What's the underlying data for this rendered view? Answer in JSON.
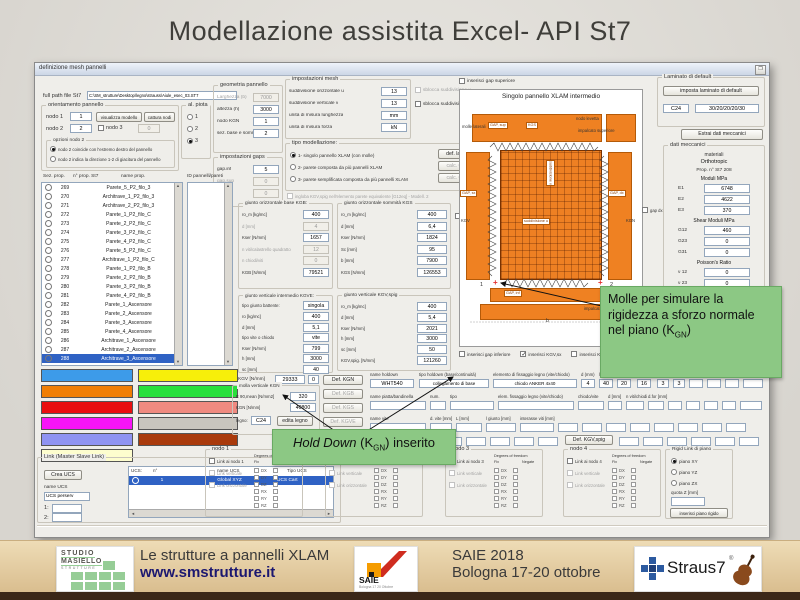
{
  "slide": {
    "title": "Modellazione assistita Excel- API St7"
  },
  "win": {
    "title": "definizione mesh pannelli"
  },
  "fullpath": {
    "label": "full path file St7",
    "value": "C:\\SM_strutture\\Desktop\\legno\\strauss\\Aiule_esec_03.ST7"
  },
  "orient": {
    "title": "orientamento pannello",
    "nodo1": "nodo 1",
    "nodo1_v": "1",
    "btn_vis": "visualizza modello",
    "btn_cat": "cattura nodi",
    "nodo2": "nodo 2",
    "nodo2_v": "2",
    "nodo3": "nodo 3",
    "nodo3_v": "0",
    "opz_title": "opzioni nodo 2",
    "r1": "nodo 2 coincide con l'estremo destro del pannello",
    "r2": "nodo 2 indica la direzione 1-2 di giacitura del pannello"
  },
  "alpiota": {
    "title": "al. piota",
    "opts": [
      "1",
      "2",
      "3"
    ]
  },
  "geom": {
    "title": "geometria pannello",
    "rows": [
      {
        "l": "Larghezza (b)",
        "v": "7000",
        "dis": true
      },
      {
        "l": "altezza (h)",
        "v": "3000"
      },
      {
        "l": "nodo KGN",
        "v": "1"
      },
      {
        "l": "sez. base e sommità",
        "v": "2"
      }
    ]
  },
  "gaps": {
    "title": "impostazioni gaps",
    "rows": [
      {
        "l": "gap.inf",
        "v": "5"
      },
      {
        "l": "gap.sup",
        "v": "0",
        "dis": true
      },
      {
        "l": "gap.nc",
        "v": "0",
        "dis": true
      }
    ]
  },
  "mesh": {
    "title": "impostazioni mesh",
    "rows": [
      {
        "l": "suddivisione orizzontale u",
        "v": "13"
      },
      {
        "l": "suddivisione verticale v",
        "v": "13"
      },
      {
        "l": "unità di misura lunghezza",
        "v": "mm"
      },
      {
        "l": "unità di misura forza",
        "v": "kN"
      }
    ],
    "cb_u": "sblocca suddivisione u",
    "cb_v": "sblocca suddivisione v"
  },
  "model": {
    "title": "tipo modellazione:",
    "opts": [
      "1- singolo pannello XLAM (con molle)",
      "2- parete composta da più pannelli XLAM",
      "3- parete semplificata composta da più pannelli XLAM"
    ],
    "btns": [
      {
        "label": "def. laminato"
      },
      {
        "label": "calc. G12,eq",
        "dis": true
      },
      {
        "label": "calc. G12,eq",
        "dis": true
      }
    ],
    "cb": "ingloba KGV,spig nell'elemento parete equivalente [G12eq] - Modell. 2"
  },
  "kgb": {
    "title": "giunto orizzontale base KGB:",
    "rows": [
      {
        "l": "ro_m [kg/mc]",
        "v": "400"
      },
      {
        "l": "d [mm]",
        "v": "4",
        "dis": true
      },
      {
        "l": "Kser [N/mm]",
        "v": "1657"
      },
      {
        "l": "n viti/calastrello quadratto",
        "v": "12",
        "dis": true
      },
      {
        "l": "n chiodi/viti",
        "v": "0",
        "dis": true
      },
      {
        "l": "KGB [N/mm]",
        "v": "79521"
      }
    ]
  },
  "kgs": {
    "title": "giunto orizzontale sommità KGS",
    "rows": [
      {
        "l": "ro_m [kg/mc]",
        "v": "400"
      },
      {
        "l": "d [mm]",
        "v": "6,4"
      },
      {
        "l": "Kser [N/mm]",
        "v": "1824"
      },
      {
        "l": "Sc [mm]",
        "v": "95"
      },
      {
        "l": "b [mm]",
        "v": "7900"
      },
      {
        "l": "KGS [N/mm]",
        "v": "126553"
      }
    ],
    "cb": "gap sx"
  },
  "kgve": {
    "title": "giunto verticale intermedio KGVE:",
    "tipo_l": "tipo giunto battente:",
    "tipo_v": "singola",
    "rows": [
      {
        "l": "ro [kg/mc]",
        "v": "400"
      },
      {
        "l": "d [mm]",
        "v": "5,1"
      },
      {
        "l": "tipo vite o chiodo",
        "v": "vite"
      },
      {
        "l": "Kser [N/mm]",
        "v": "799"
      },
      {
        "l": "h [mm]",
        "v": "3000"
      },
      {
        "l": "sc [mm]",
        "v": "40"
      }
    ],
    "kgv_l": "KGV [N/mm]",
    "kgv_v1": "29333",
    "kgv_v2": "0"
  },
  "kgvspig": {
    "title": "giunto verticale KGV,spig",
    "rows": [
      {
        "l": "ro_m [kg/mc]",
        "v": "400"
      },
      {
        "l": "d [mm]",
        "v": "5,4"
      },
      {
        "l": "Kser [N/mm]",
        "v": "2021"
      },
      {
        "l": "h [mm]",
        "v": "3000"
      },
      {
        "l": "sc [mm]",
        "v": "50"
      },
      {
        "l": "KGV,spig. [N/mm]",
        "v": "121260"
      }
    ]
  },
  "kgn": {
    "title": "molla verticale KGN",
    "rows": [
      {
        "l": "E 90,mean [N/mm2]",
        "v": "320"
      },
      {
        "l": "KGN [N/mm]",
        "v": "40800"
      }
    ],
    "legno_l": "legno:",
    "legno_v": "C24",
    "btn": "edita legno"
  },
  "defbtns": [
    {
      "label": "Def. KGN"
    },
    {
      "label": "Def. KGB",
      "dis": true
    },
    {
      "label": "Def. KGS",
      "dis": true
    },
    {
      "label": "Def. KGVE",
      "dis": true
    }
  ],
  "holddown": {
    "r1": [
      {
        "l": "name holdown",
        "v": "WHT540"
      },
      {
        "l": "tipo holdown (base/continuità)",
        "v": "collegamento di base"
      },
      {
        "l": "elemento di fissaggio legno (vite/chiodo)",
        "v": "chiodo ANKER 4x40"
      },
      {
        "l": "d (mm)",
        "v": "4"
      },
      {
        "l": "l [mm]",
        "v": "40"
      },
      {
        "l": "n viti/chiodi",
        "v": "20"
      },
      {
        "l": "d.for [mm]",
        "v": "16"
      },
      {
        "l": "t [mm]",
        "v": "3"
      },
      {
        "l": "n. fori",
        "v": "3"
      }
    ],
    "r2": [
      "name piatta/bandinella",
      "num.",
      "tipo",
      "elem. fissaggio legno (vite/chiodo)",
      "chiodo/vite",
      "d [mm]",
      "n viti/chiodi",
      "d.for [mm]"
    ],
    "r3": [
      "name vite",
      "d. vite [mm]",
      "L [mm]",
      "l giunto [mm]",
      "interasse viti [mm]"
    ],
    "def_btn": "Def. KGV,spig"
  },
  "lists": {
    "h_sez": "Sez. prop.",
    "h_n": "n° prop. St7",
    "h_name": "name prop.",
    "h_id": "ID pannelli/pareti",
    "props": [
      {
        "n": "269",
        "name": "Parete_5_P2_filo_3"
      },
      {
        "n": "270",
        "name": "Architrave_1_P2_filo_3"
      },
      {
        "n": "271",
        "name": "Architrave_2_P2_filo_3"
      },
      {
        "n": "272",
        "name": "Parete_1_P2_filo_C"
      },
      {
        "n": "273",
        "name": "Parete_2_P2_filo_C"
      },
      {
        "n": "274",
        "name": "Parete_3_P2_filo_C"
      },
      {
        "n": "275",
        "name": "Parete_4_P2_filo_C"
      },
      {
        "n": "276",
        "name": "Parete_5_P2_filo_C"
      },
      {
        "n": "277",
        "name": "Architrave_1_P2_filo_C"
      },
      {
        "n": "278",
        "name": "Parete_1_P2_filo_B"
      },
      {
        "n": "279",
        "name": "Parete_2_P2_filo_B"
      },
      {
        "n": "280",
        "name": "Parete_3_P2_filo_B"
      },
      {
        "n": "281",
        "name": "Parete_4_P2_filo_B"
      },
      {
        "n": "282",
        "name": "Parete_1_Ascensore"
      },
      {
        "n": "283",
        "name": "Parete_2_Ascensore"
      },
      {
        "n": "284",
        "name": "Parete_3_Ascensore"
      },
      {
        "n": "285",
        "name": "Parete_4_Ascensore"
      },
      {
        "n": "286",
        "name": "Architrave_1_Ascensore"
      },
      {
        "n": "287",
        "name": "Architrave_2_Ascensore"
      },
      {
        "n": "288",
        "name": "Architrave_3_Ascensore",
        "selected": true
      }
    ],
    "ids": [
      "1",
      "2",
      "3",
      "4",
      "5",
      "6",
      "7",
      "8",
      "9",
      "10",
      "11",
      "12",
      "13",
      "14",
      "15",
      "16",
      "17",
      "18",
      "19",
      "20",
      "21",
      "22",
      "23",
      "24",
      "25",
      "26",
      "27",
      "28"
    ]
  },
  "actions": [
    {
      "label": "Crea Mesh pannello/parete",
      "c": "c-blue"
    },
    {
      "label": "Inserisci Master-Slave Link",
      "c": "c-yellow"
    },
    {
      "label": "Copia pareti",
      "c": "c-orange"
    },
    {
      "label": "Clean Mesh",
      "c": "c-green"
    },
    {
      "label": "Cancella prop. St7/riutilizzabile",
      "c": "c-red"
    },
    {
      "label": "Cancella prop. St7 selezionata",
      "c": "c-salmon"
    },
    {
      "label": "Edita pareti",
      "c": "c-magenta"
    },
    {
      "label": "Cancella parete/pannello ID",
      "c": "c-gray"
    },
    {
      "label": "Crea Mesh solaio",
      "c": "c-peri"
    },
    {
      "label": "Crea graticcio travi",
      "c": "c-brown"
    },
    {
      "label": "Consulta database pareti",
      "c": "c-cream"
    }
  ],
  "link": {
    "title": "Link (Master Slave Link)",
    "btn_ucs": "Crea UCS",
    "name_l": "name UCS",
    "name_v": "UCS perserv",
    "f1": "1:",
    "f2": "2:",
    "th_ucs": "UCS:",
    "th_n": "n°",
    "th_name": "name UCS",
    "th_tipo": "Tipo UCS",
    "row": {
      "n": "1",
      "name": "Global XYZ",
      "tipo": "UCS Cart"
    }
  },
  "nodi": [
    {
      "title": "nodo 1",
      "cb": "Link ai nodo 1"
    },
    {
      "title": "nodo 2",
      "cb": "Link ai nodo 2"
    },
    {
      "title": "nodo 3",
      "cb": "Link ai nodo 3"
    },
    {
      "title": "nodo 4",
      "cb": "Link ai nodo 4"
    }
  ],
  "nodo_shared": {
    "cb_v": "Link verticale",
    "cb_o": "Link orizzontale",
    "dof_h": "Degrees of freedom",
    "fix": "Fix",
    "neg": "Negate"
  },
  "dof": {
    "rows": [
      "DX",
      "DY",
      "DZ",
      "RX",
      "RY",
      "RZ"
    ]
  },
  "rigid": {
    "title": "Rigid Link di piano",
    "opts": [
      "piano XY",
      "piano YZ",
      "piano ZX"
    ],
    "quota": "quota  Z [mm]",
    "btn": "inserisci piano rigido"
  },
  "laminato": {
    "title": "Laminato di default",
    "btn": "imposta laminato di default",
    "v1": "C24",
    "v2": "30/20/20/20/30",
    "btn_estrai": "Estrai dati meccanici"
  },
  "dati": {
    "title": "dati meccanici",
    "materiali": "materiali",
    "tipo": "Orthotropic",
    "prop": "Prop. n° St7  208",
    "h_mod": "Moduli MPa",
    "rows_e": [
      {
        "l": "E1",
        "v": "6748"
      },
      {
        "l": "E2",
        "v": "4622"
      },
      {
        "l": "E3",
        "v": "370"
      }
    ],
    "h_shear": "Shear Moduli MPa",
    "rows_g": [
      {
        "l": "G12",
        "v": "460"
      },
      {
        "l": "G23",
        "v": "0"
      },
      {
        "l": "G31",
        "v": "0"
      }
    ],
    "h_pois": "Poisson's Ratio",
    "rows_p": [
      {
        "l": "ν 12",
        "v": "0"
      },
      {
        "l": "ν 23",
        "v": "0"
      },
      {
        "l": "ν 31",
        "v": "0"
      }
    ]
  },
  "diagram": {
    "title": "Singolo pannello XLAM intermedio",
    "cb_sup": "inserisci gap superiore",
    "cb_dx": "gap dx",
    "lbl_molle": "molle laterali",
    "lbl_nodo": "nodo levetta",
    "lbl_imp_sup": "impalcato superiore",
    "lbl_imp_inf": "impalcato inferiore",
    "tag_gap_sup": "GAP, sup",
    "tag_kgs": "KGS",
    "tag_gap_sx": "GAP, sx",
    "tag_gap_dx": "GAP, dx",
    "tag_gap_inf": "GAP, inf",
    "lbl_kgv": "KGV",
    "lbl_kgn": "KGN",
    "lbl_sudd_u": "suddivisione u",
    "lbl_sudd_v": "suddivisione v",
    "n1": "1",
    "n2": "2",
    "dim_b": "b",
    "legend": [
      "KGV : rigidezza complessiva giunto verticale interno",
      "KGV,spig : rigidezza complessiva giunto verticale spigolo",
      "KGB : rigidezza complessiva giunto di base",
      "KGS : rigidezza complessiva giunto superiore",
      "KGN : rigidezza a sforzo normale nel piano"
    ],
    "cbs": [
      {
        "label": "inserisci gap inferiore"
      },
      {
        "label": "inserisci KGV,sx",
        "checked": true
      },
      {
        "label": "inserisci KGV,dx"
      }
    ]
  },
  "callout1": {
    "pre": "Molle per simulare la rigidezza a sforzo normale nel piano (K",
    "sub": "GN",
    "post": ")"
  },
  "callout2": {
    "italic": "Hold Down",
    "pre": " (K",
    "sub": "GN",
    "post": ") inserito"
  },
  "footer": {
    "sm1": "STUDIO",
    "sm2": "MASIELLO",
    "sm3": "STRUTTURE",
    "caption1": "Le strutture a pannelli XLAM",
    "caption1b": "www.smstrutture.it",
    "saie": "SAIE",
    "saie_sub": "Bologna 17 20 Ottobre",
    "caption2": "SAIE 2018",
    "caption2b": "Bologna 17-20 ottobre",
    "straus": "Straus7",
    "reg": "®"
  }
}
